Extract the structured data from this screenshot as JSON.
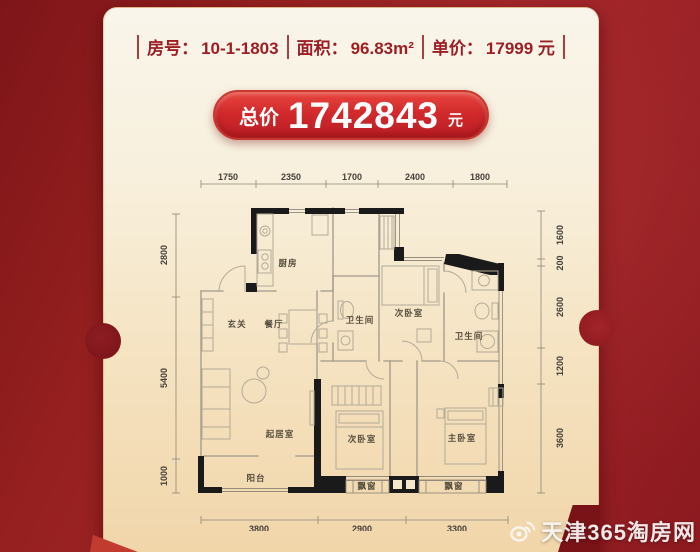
{
  "header": {
    "items": [
      {
        "label": "房号：",
        "value": "10-1-1803"
      },
      {
        "label": "面积：",
        "value": "96.83m²"
      },
      {
        "label": "单价：",
        "value": "17999 元"
      }
    ]
  },
  "price": {
    "label": "总价",
    "value": "1742843",
    "unit": "元"
  },
  "floorplan": {
    "rooms": {
      "kitchen": "厨房",
      "entry": "玄关",
      "dining": "餐厅",
      "bath1": "卫生间",
      "bed2_top": "次卧室",
      "bath2": "卫生间",
      "living": "起居室",
      "balcony": "阳台",
      "bed2_bottom": "次卧室",
      "bay1": "飘窗",
      "master": "主卧室",
      "bay2": "飘窗"
    },
    "dims": {
      "top": [
        "1750",
        "2350",
        "1700",
        "2400",
        "1800"
      ],
      "left": [
        "2800",
        "5400",
        "1000"
      ],
      "right": [
        "1600",
        "200",
        "2600",
        "1200",
        "3600"
      ],
      "bottom": [
        "3800",
        "2900",
        "3300"
      ]
    }
  },
  "watermark": {
    "text": "天津365淘房网",
    "icon": "weibo-icon"
  },
  "colors": {
    "background_red": "#8f1d22",
    "card_cream": "#f6ecd6",
    "price_pill_red": "#cd2128",
    "header_text_red": "#9c2127",
    "wall_black": "#1a1a1a",
    "watermark_white": "#f8f6f2"
  }
}
